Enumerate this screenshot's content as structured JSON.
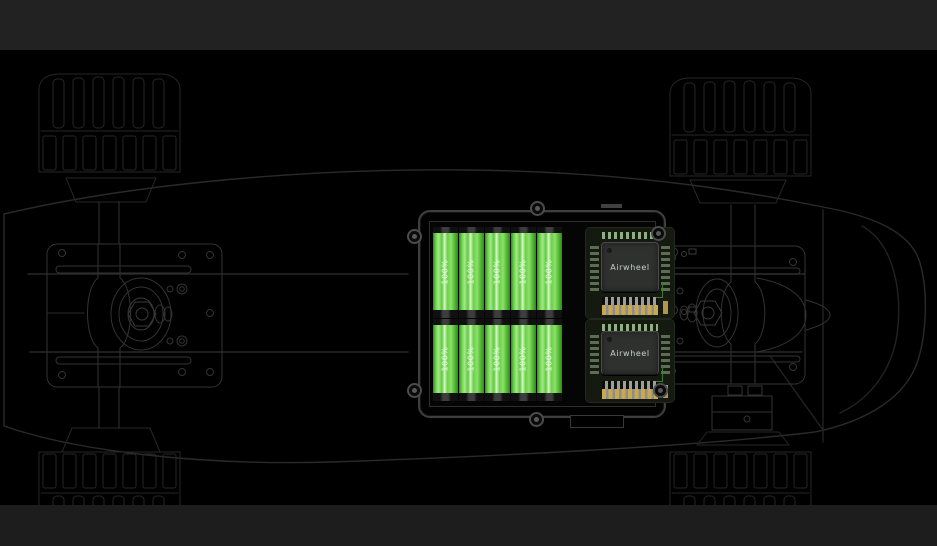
{
  "colors": {
    "background": "#000000",
    "top_band": "#222222",
    "bottom_band": "#1d1d1d",
    "wireframe_line": "#2b2b2b",
    "battery_green": "#5fc93e",
    "battery_highlight": "#d8f7c6",
    "pcb_dark": "#141a10",
    "chip_body": "#2f312f",
    "chip_text": "#c7d1c9",
    "gold_pad": "#c9a853"
  },
  "battery_box": {
    "rows": [
      {
        "batteries": [
          {
            "label": "100%"
          },
          {
            "label": "100%"
          },
          {
            "label": "100%"
          },
          {
            "label": "100%"
          },
          {
            "label": "100%"
          }
        ],
        "chip": {
          "brand": "Airwheel"
        }
      },
      {
        "batteries": [
          {
            "label": "100%"
          },
          {
            "label": "100%"
          },
          {
            "label": "100%"
          },
          {
            "label": "100%"
          },
          {
            "label": "100%"
          }
        ],
        "chip": {
          "brand": "Airwheel"
        }
      }
    ]
  }
}
